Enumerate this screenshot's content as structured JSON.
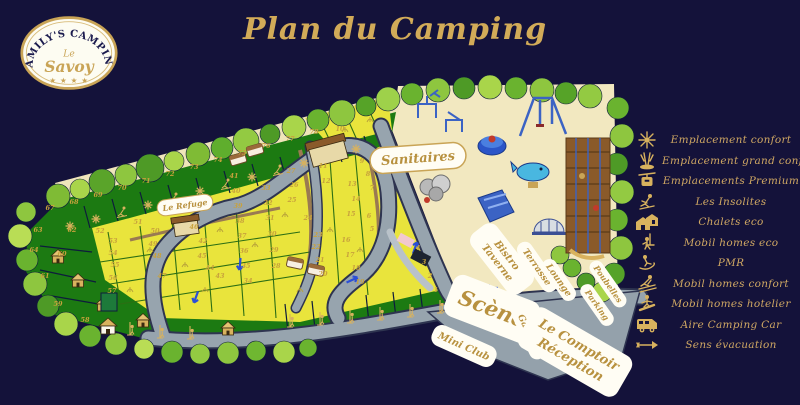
{
  "title": "Plan du Camping",
  "logo": {
    "arc_text": "FAMILY'S CAMPING",
    "middle_small": "Le",
    "middle_large": "Savoy",
    "stars": "★ ★ ★ ★"
  },
  "legend": {
    "items": [
      {
        "icon": "edelweiss-icon",
        "label": "Emplacement confort"
      },
      {
        "icon": "skis-icon",
        "label": "Emplacement grand confort"
      },
      {
        "icon": "gondola-icon",
        "label": "Emplacements Premium"
      },
      {
        "icon": "skier-icon",
        "label": "Les Insolites"
      },
      {
        "icon": "chalets-icon",
        "label": "Chalets eco"
      },
      {
        "icon": "chairlift-icon",
        "label": "Mobil homes eco"
      },
      {
        "icon": "sledge-icon",
        "label": "PMR"
      },
      {
        "icon": "slalom-skier-icon",
        "label": "Mobil homes confort"
      },
      {
        "icon": "snowboarder-icon",
        "label": "Mobil homes hotelier"
      },
      {
        "icon": "campervan-icon",
        "label": "Aire Camping Car"
      },
      {
        "icon": "evacuation-arrow-icon",
        "label": "Sens évacuation"
      }
    ]
  },
  "map": {
    "labels": {
      "sanitaires": "Sanitaires",
      "le_refuge": "Le Refuge",
      "bistro_line1": "Bistro",
      "bistro_line2": "Taverne",
      "terrasse": "Terrasse",
      "lounge": "Lounge",
      "poubelles": "Poubelles",
      "parking": "Parking",
      "scene": "Scène",
      "mini_club": "Mini Club",
      "gardien": "Gardien",
      "comptoir_line1": "Le Comptoir",
      "comptoir_line2": "Réception"
    },
    "pitch_numbers": [
      {
        "n": "1",
        "x": 436,
        "y": 292
      },
      {
        "n": "2",
        "x": 430,
        "y": 278
      },
      {
        "n": "3",
        "x": 424,
        "y": 264
      },
      {
        "n": "4",
        "x": 418,
        "y": 250
      },
      {
        "n": "5",
        "x": 372,
        "y": 231
      },
      {
        "n": "6",
        "x": 369,
        "y": 218
      },
      {
        "n": "7",
        "x": 372,
        "y": 190
      },
      {
        "n": "8",
        "x": 368,
        "y": 176
      },
      {
        "n": "9",
        "x": 362,
        "y": 163
      },
      {
        "n": "10",
        "x": 340,
        "y": 131
      },
      {
        "n": "11",
        "x": 323,
        "y": 168
      },
      {
        "n": "12",
        "x": 326,
        "y": 183
      },
      {
        "n": "13",
        "x": 352,
        "y": 186
      },
      {
        "n": "14",
        "x": 356,
        "y": 201
      },
      {
        "n": "15",
        "x": 351,
        "y": 216
      },
      {
        "n": "16",
        "x": 346,
        "y": 242
      },
      {
        "n": "17",
        "x": 350,
        "y": 257
      },
      {
        "n": "18",
        "x": 356,
        "y": 270
      },
      {
        "n": "19",
        "x": 360,
        "y": 284
      },
      {
        "n": "20",
        "x": 323,
        "y": 276
      },
      {
        "n": "21",
        "x": 320,
        "y": 262
      },
      {
        "n": "22",
        "x": 316,
        "y": 249
      },
      {
        "n": "23",
        "x": 318,
        "y": 237
      },
      {
        "n": "24",
        "x": 308,
        "y": 220
      },
      {
        "n": "25",
        "x": 292,
        "y": 202
      },
      {
        "n": "26",
        "x": 294,
        "y": 187
      },
      {
        "n": "27",
        "x": 291,
        "y": 173
      },
      {
        "n": "28",
        "x": 276,
        "y": 268
      },
      {
        "n": "29",
        "x": 274,
        "y": 252
      },
      {
        "n": "30",
        "x": 272,
        "y": 236
      },
      {
        "n": "31",
        "x": 270,
        "y": 220
      },
      {
        "n": "32",
        "x": 268,
        "y": 205
      },
      {
        "n": "33",
        "x": 266,
        "y": 190
      },
      {
        "n": "34",
        "x": 248,
        "y": 283
      },
      {
        "n": "35",
        "x": 246,
        "y": 268
      },
      {
        "n": "36",
        "x": 244,
        "y": 253
      },
      {
        "n": "37",
        "x": 242,
        "y": 238
      },
      {
        "n": "38",
        "x": 240,
        "y": 223
      },
      {
        "n": "39",
        "x": 238,
        "y": 208
      },
      {
        "n": "40",
        "x": 236,
        "y": 193
      },
      {
        "n": "41",
        "x": 234,
        "y": 178
      },
      {
        "n": "42",
        "x": 203,
        "y": 243
      },
      {
        "n": "43",
        "x": 220,
        "y": 278
      },
      {
        "n": "44",
        "x": 210,
        "y": 270
      },
      {
        "n": "45",
        "x": 202,
        "y": 258
      },
      {
        "n": "46",
        "x": 194,
        "y": 229
      },
      {
        "n": "47",
        "x": 162,
        "y": 278
      },
      {
        "n": "48",
        "x": 157,
        "y": 258
      },
      {
        "n": "49",
        "x": 153,
        "y": 246
      },
      {
        "n": "50",
        "x": 155,
        "y": 233
      },
      {
        "n": "51",
        "x": 138,
        "y": 224
      },
      {
        "n": "52",
        "x": 100,
        "y": 233
      },
      {
        "n": "53",
        "x": 113,
        "y": 243
      },
      {
        "n": "54",
        "x": 113,
        "y": 255
      },
      {
        "n": "55",
        "x": 115,
        "y": 267
      },
      {
        "n": "56",
        "x": 113,
        "y": 280
      },
      {
        "n": "57",
        "x": 112,
        "y": 293
      },
      {
        "n": "58",
        "x": 85,
        "y": 322
      },
      {
        "n": "59",
        "x": 58,
        "y": 306
      },
      {
        "n": "60",
        "x": 62,
        "y": 256
      },
      {
        "n": "61",
        "x": 45,
        "y": 278
      },
      {
        "n": "62",
        "x": 72,
        "y": 232
      },
      {
        "n": "63",
        "x": 38,
        "y": 232
      },
      {
        "n": "64",
        "x": 34,
        "y": 252
      },
      {
        "n": "67",
        "x": 50,
        "y": 210
      },
      {
        "n": "68",
        "x": 74,
        "y": 204
      },
      {
        "n": "69",
        "x": 98,
        "y": 197
      },
      {
        "n": "70",
        "x": 122,
        "y": 190
      },
      {
        "n": "71",
        "x": 146,
        "y": 183
      },
      {
        "n": "72",
        "x": 170,
        "y": 176
      },
      {
        "n": "73",
        "x": 194,
        "y": 169
      },
      {
        "n": "74",
        "x": 218,
        "y": 162
      },
      {
        "n": "75",
        "x": 242,
        "y": 155
      },
      {
        "n": "76",
        "x": 266,
        "y": 148
      },
      {
        "n": "77",
        "x": 290,
        "y": 141
      },
      {
        "n": "78",
        "x": 314,
        "y": 134
      }
    ]
  },
  "colors": {
    "background": "#14123a",
    "gold": "#cfa763",
    "label_text": "#b8913f",
    "map_green_dark": "#1c7a12",
    "pitch_yellow": "#e9e43c",
    "road_gray": "#97a4ae",
    "sand": "#f2e8c0",
    "evac_sign_green": "#129a52",
    "playground_blue": "#3b63c4"
  }
}
